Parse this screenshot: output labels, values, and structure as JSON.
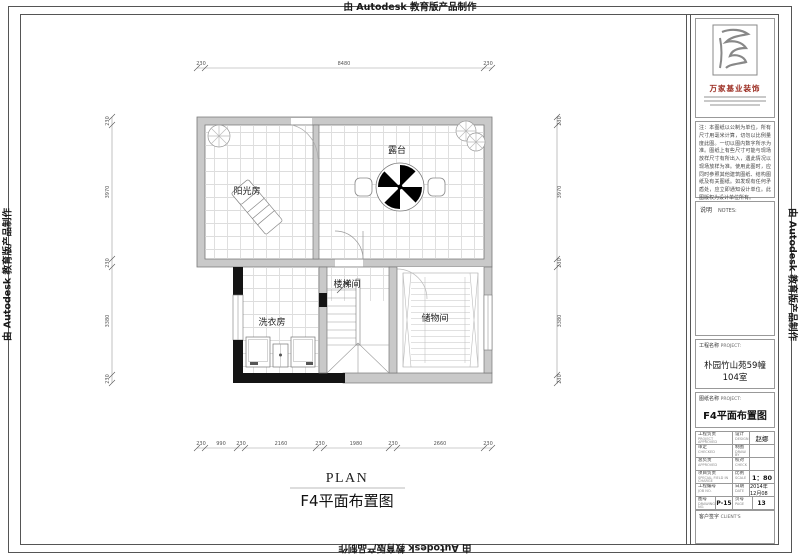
{
  "edge": {
    "autodesk": "由 Autodesk 教育版产品制作"
  },
  "plan": {
    "labels": {
      "terrace": "露台",
      "sunroom": "阳光房",
      "stairs": "楼梯间",
      "laundry": "洗衣房",
      "storage": "储物间"
    },
    "title_en": "PLAN",
    "title_cn": "F4平面布置图",
    "dims": {
      "top": [
        "230",
        "8480",
        "230"
      ],
      "side": [
        "230",
        "3970",
        "230",
        "3380",
        "230"
      ],
      "bottom": [
        "230",
        "990",
        "230",
        "2160",
        "230",
        "1980",
        "230",
        "2660",
        "230"
      ]
    }
  },
  "titleblock": {
    "brand": "万家基业装饰",
    "notes_text": "注：本图纸以公制为单位，所有尺寸用毫米计算，切勿以比例量度此图。一切以图内数字所示为准。图纸上有些尺寸可能与现场放样尺寸有所出入，遇此情况以现场放样为准。使用此图时，应同时参照其他建筑图纸、结构图纸及有关图纸。如发现有任何矛盾处，应立即通知设计单位。此图版权为设计单位所有。",
    "notes_cn": "说明",
    "notes_en": "NOTES:",
    "project_cn": "工程名称",
    "project_en": "PROJECT:",
    "project_value": "朴园竹山苑59幢104室",
    "drawing_cn": "图纸名称",
    "drawing_en": "PROJECT:",
    "drawing_value": "F4平面布置图",
    "client_cn": "客户签字",
    "client_en": "CLIENT'S",
    "table": {
      "r1l": "工程负责",
      "r1l_en": "PROJECT APPROVED",
      "r1r": "设计",
      "r1r_en": "DESIGN",
      "r1v": "赵娜",
      "r2l": "审定",
      "r2l_en": "CHECKED",
      "r2r": "制图",
      "r2r_en": "DRAW. BY",
      "r2v": "",
      "r3l": "总负责",
      "r3l_en": "APPROVED",
      "r3r": "校对",
      "r3r_en": "CHECK",
      "r3v": "",
      "r4l": "项目负责",
      "r4l_en": "SPECIAL FIELD IN CHARGE",
      "r4r": "比例",
      "r4r_en": "SCALE",
      "r4v": "1：80",
      "r5l": "工程编号",
      "r5l_en": "JOB NO.",
      "r5r": "日期",
      "r5r_en": "DATE",
      "r5v": "2014年12月08",
      "r6l": "图号",
      "r6l_en": "DRAWING NO.",
      "r6lv": "P-15",
      "r6r": "页号",
      "r6r_en": "PAGE",
      "r6rv": "13"
    }
  }
}
